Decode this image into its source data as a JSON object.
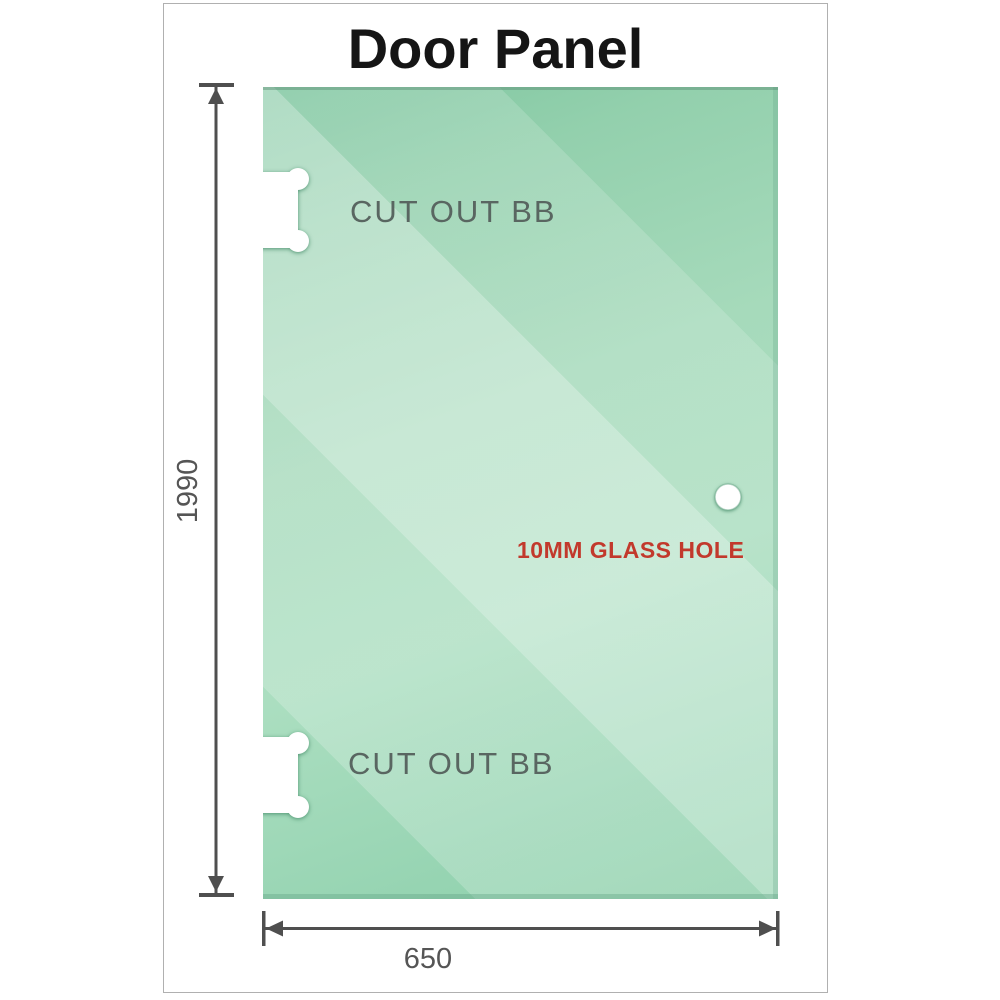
{
  "title": "Door Panel",
  "glass_panel": {
    "cutouts": [
      {
        "label": "CUT OUT BB",
        "position": "top-left"
      },
      {
        "label": "CUT OUT BB",
        "position": "bottom-left"
      }
    ],
    "hole": {
      "label": "10MM GLASS HOLE"
    }
  },
  "dimensions": {
    "height": "1990",
    "width": "650"
  },
  "colors": {
    "glass_base": "#a6dabb",
    "glass_dark": "#7fc6a0",
    "glass_light": "#cdebd8",
    "dim_line": "#4f4f4f",
    "dim_text": "#555555",
    "cutout_text": "#596661",
    "hole_text": "#c2392c",
    "frame_border": "#b0b0b0",
    "title_color": "#151515"
  }
}
